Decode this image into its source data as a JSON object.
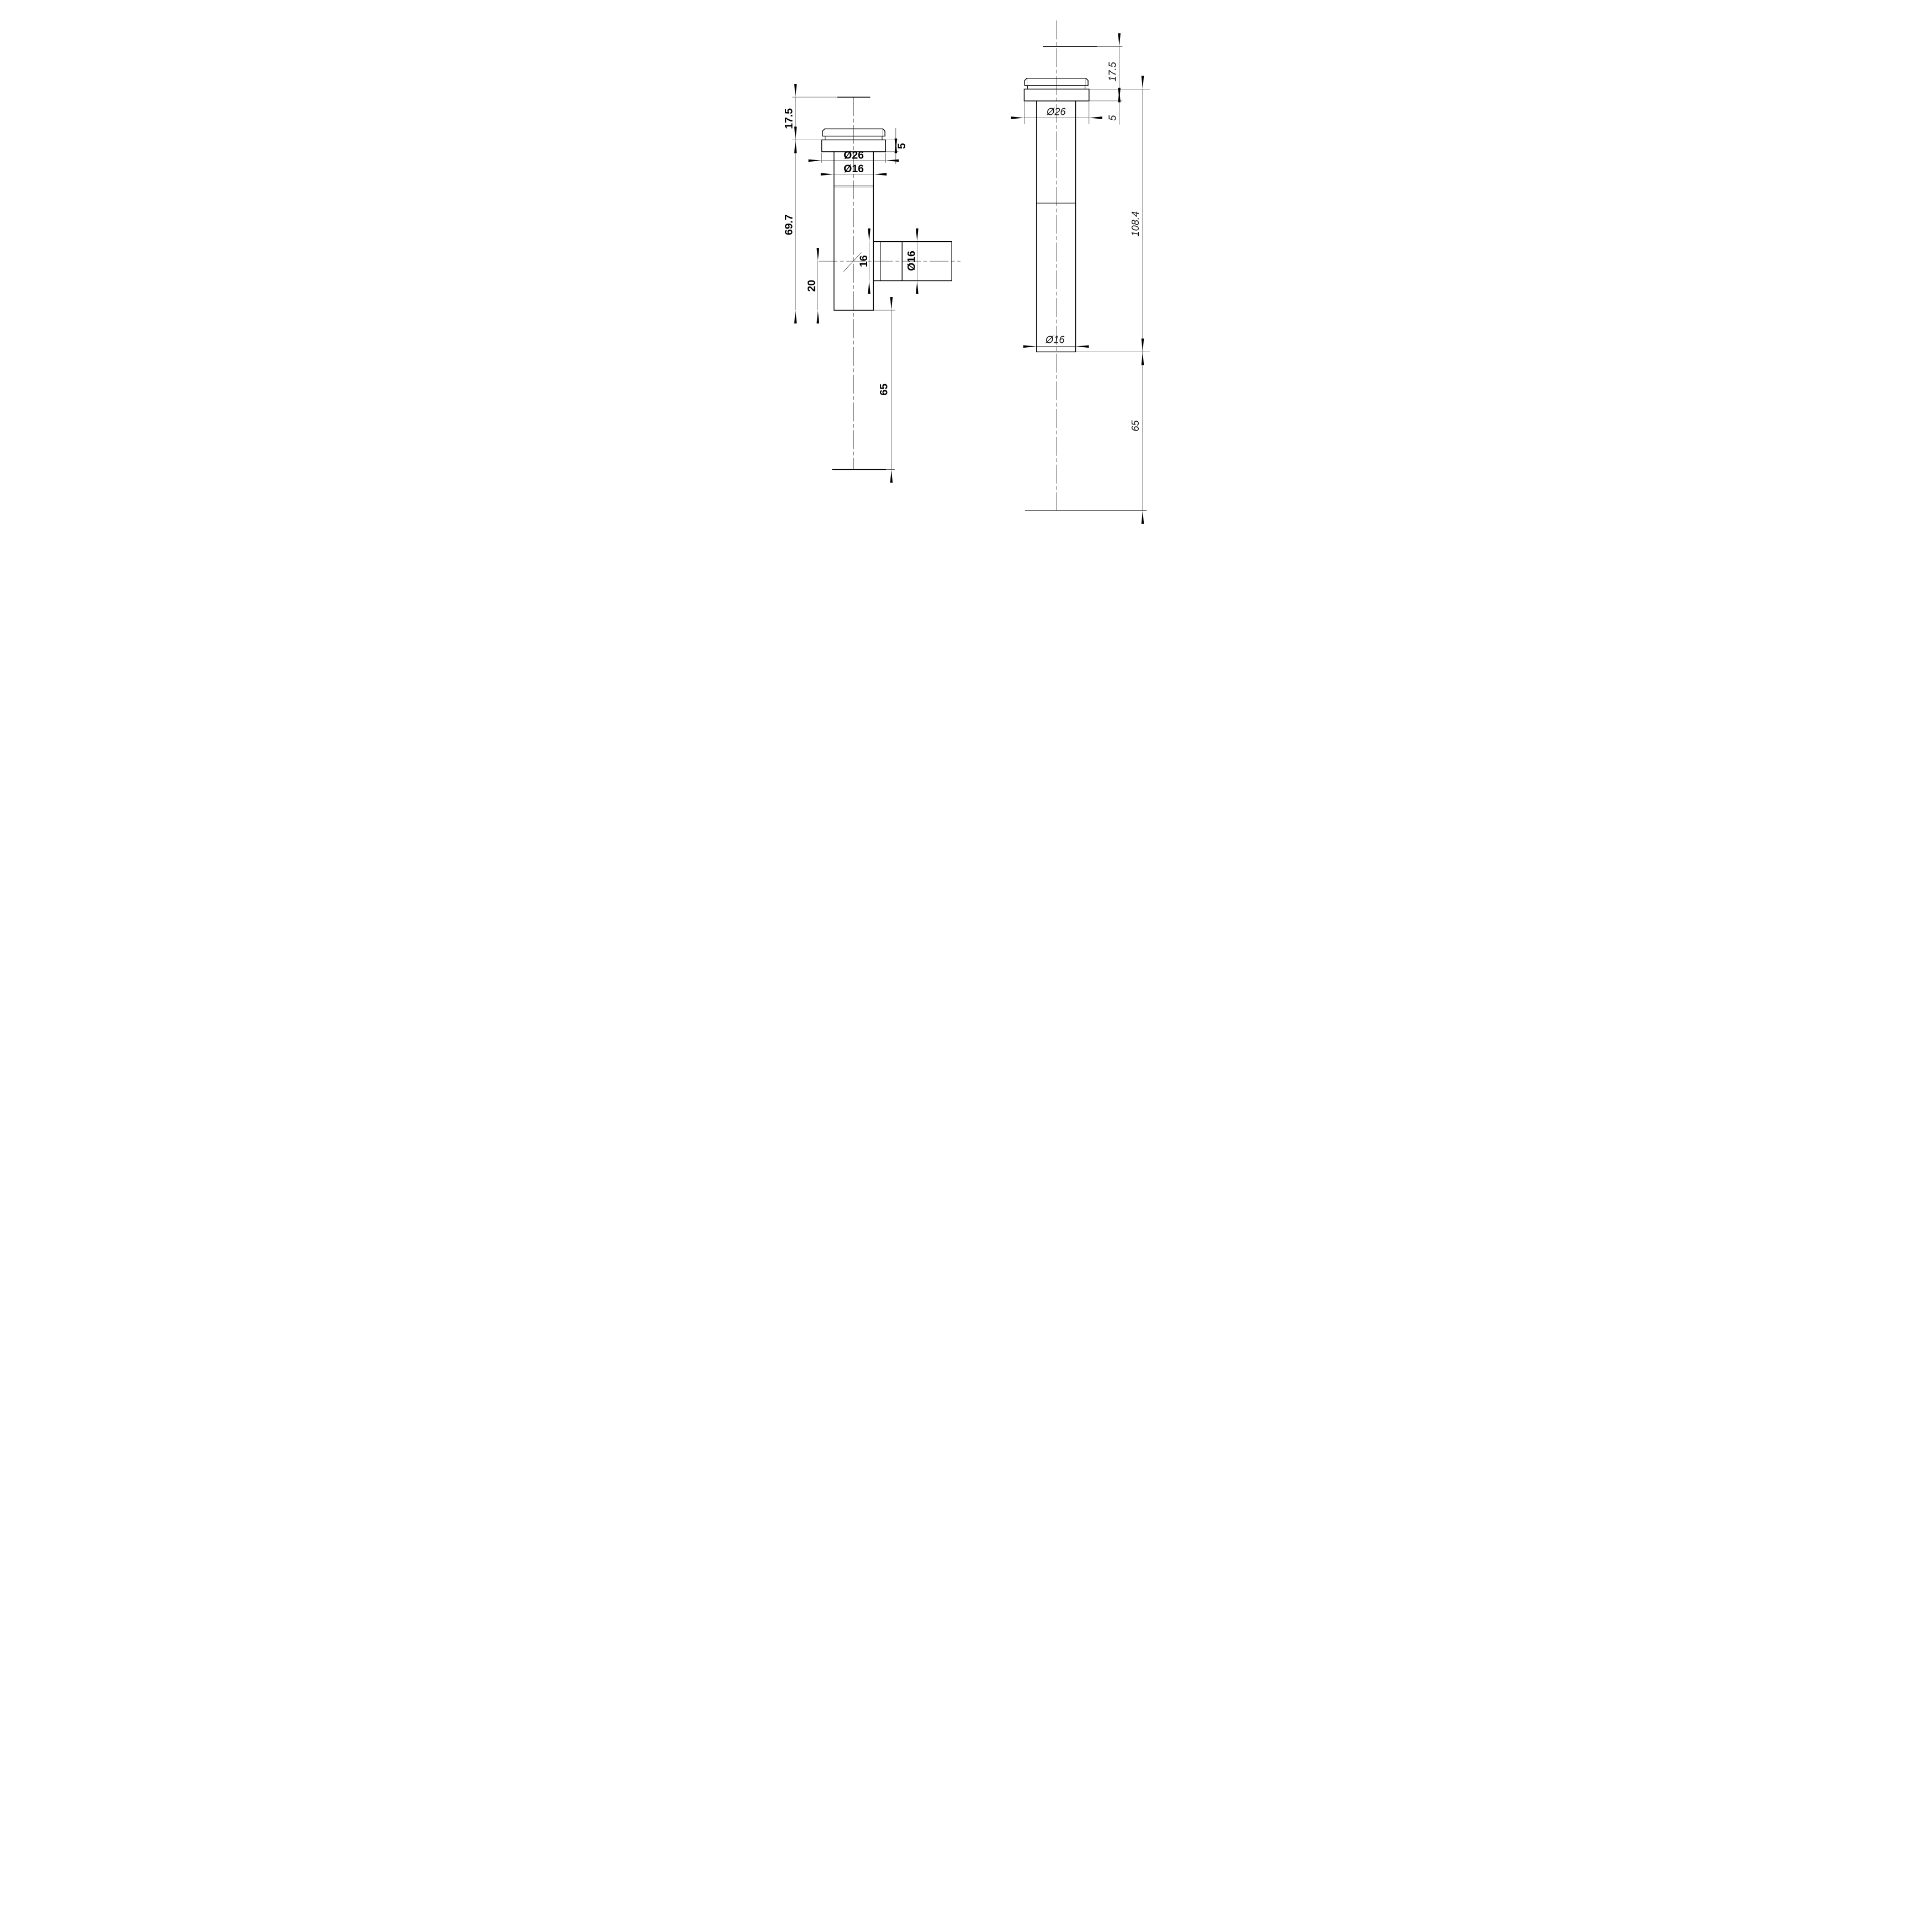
{
  "drawing": {
    "line_color": "#000000",
    "background_color": "#ffffff",
    "left_view": {
      "dim_top_height": "17.5",
      "dim_flange_thickness": "5",
      "dim_flange_diameter": "Ø26",
      "dim_pipe_diameter": "Ø16",
      "dim_body_length": "69.7",
      "dim_branch_bore": "16",
      "dim_branch_diameter": "Ø16",
      "dim_branch_offset": "20",
      "dim_lower_length": "65"
    },
    "right_view": {
      "dim_top_height": "17.5",
      "dim_flange_thickness": "5",
      "dim_flange_diameter": "Ø26",
      "dim_body_length": "108.4",
      "dim_pipe_diameter": "Ø16",
      "dim_lower_length": "65"
    }
  }
}
